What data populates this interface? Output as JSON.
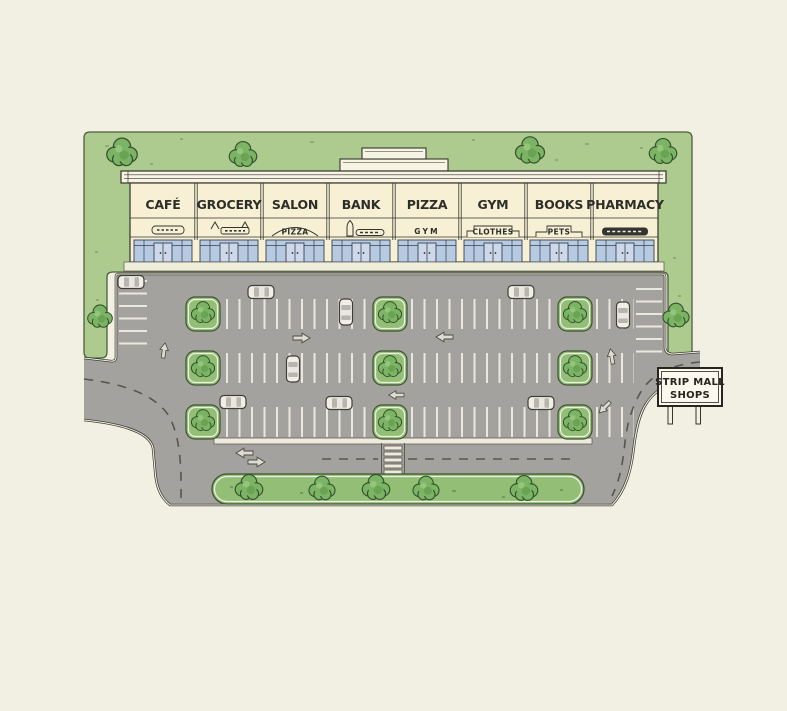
{
  "illustration": {
    "type": "strip-mall-site-plan",
    "sign": {
      "line1": "STRIP MALL",
      "line2": "SHOPS"
    },
    "building": {
      "stores": [
        {
          "name": "CAFÉ",
          "sub_label": "",
          "sub_sign": "scribble-pill"
        },
        {
          "name": "GROCERY",
          "sub_label": "",
          "sub_sign": "scribble-awning"
        },
        {
          "name": "SALON",
          "sub_label": "PIZZA",
          "sub_sign": "arched-sign"
        },
        {
          "name": "BANK",
          "sub_label": "",
          "sub_sign": "bottle-icon-and-bar"
        },
        {
          "name": "PIZZA",
          "sub_label": "GYM",
          "sub_sign": "plain-text"
        },
        {
          "name": "GYM",
          "sub_label": "CLOTHES",
          "sub_sign": "stepped-tab"
        },
        {
          "name": "BOOKS",
          "sub_label": "PETS",
          "sub_sign": "raised-tab"
        },
        {
          "name": "PHARMACY",
          "sub_label": "",
          "sub_sign": "dark-bar"
        }
      ]
    },
    "site": {
      "trees_total": 20,
      "parking_islands": 9,
      "cars": 9,
      "crosswalks": 1,
      "road_exits": 2
    },
    "colors": {
      "background": "#f2f0e3",
      "lawn": "#adcb8e",
      "island_green": "#92bf75",
      "tree_green": "#7cb465",
      "asphalt": "#a4a29e",
      "facade_cream": "#f8f0d5",
      "window_glass": "#b6cae2",
      "stall_line": "#eae8de",
      "ink": "#3f3f38",
      "sign_background": "#fbf9ee"
    }
  }
}
